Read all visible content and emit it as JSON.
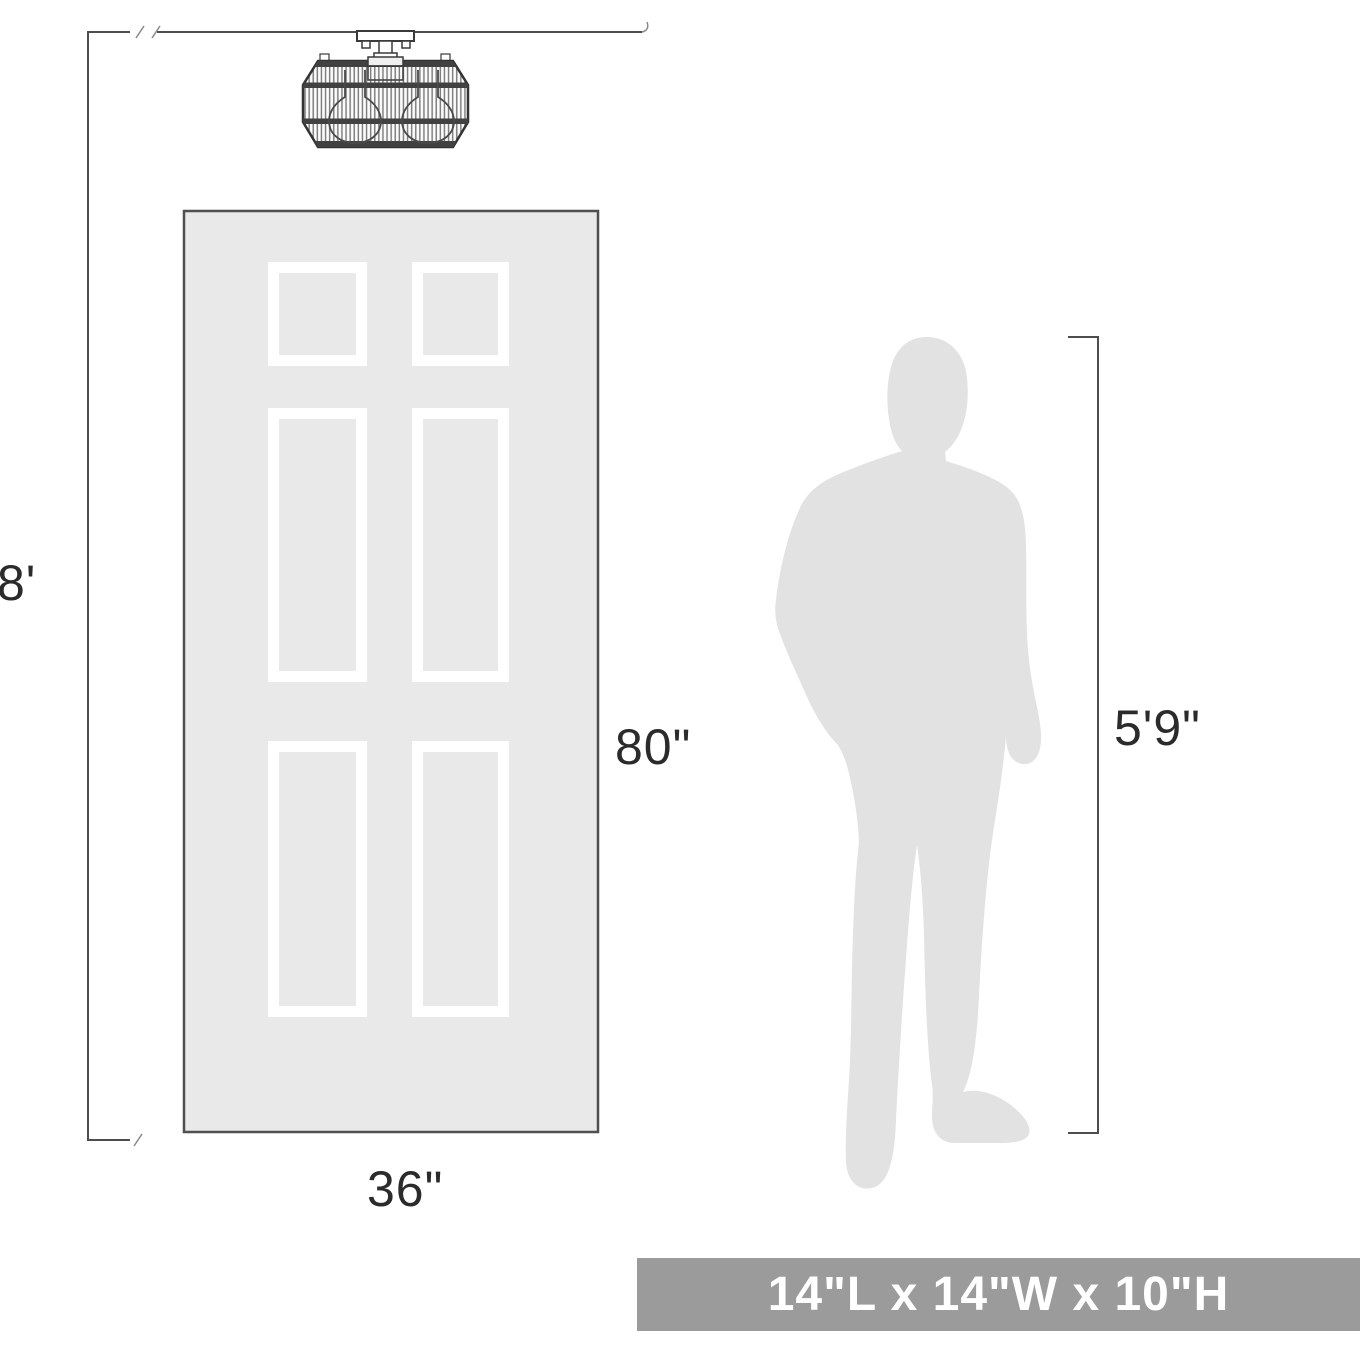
{
  "diagram": {
    "ceiling_height_label": "8'",
    "door_height_label": "80\"",
    "door_width_label": "36\"",
    "person_height_label": "5'9\"",
    "dimension_bar": {
      "label": "14\"L x 14\"W x 10\"H"
    },
    "icons": {
      "fixture": "flush-mount-ceiling-light",
      "door": "six-panel-door",
      "person": "standing-man-silhouette"
    },
    "colors": {
      "dimension_line": "#4d4d4d",
      "label_text": "#2b2b2b",
      "door_fill": "#e9e9e9",
      "door_border": "#4f4f4f",
      "panel_frame": "#ffffff",
      "silhouette": "#e2e2e2",
      "bar_background": "#9b9b9b",
      "bar_text": "#ffffff"
    }
  }
}
